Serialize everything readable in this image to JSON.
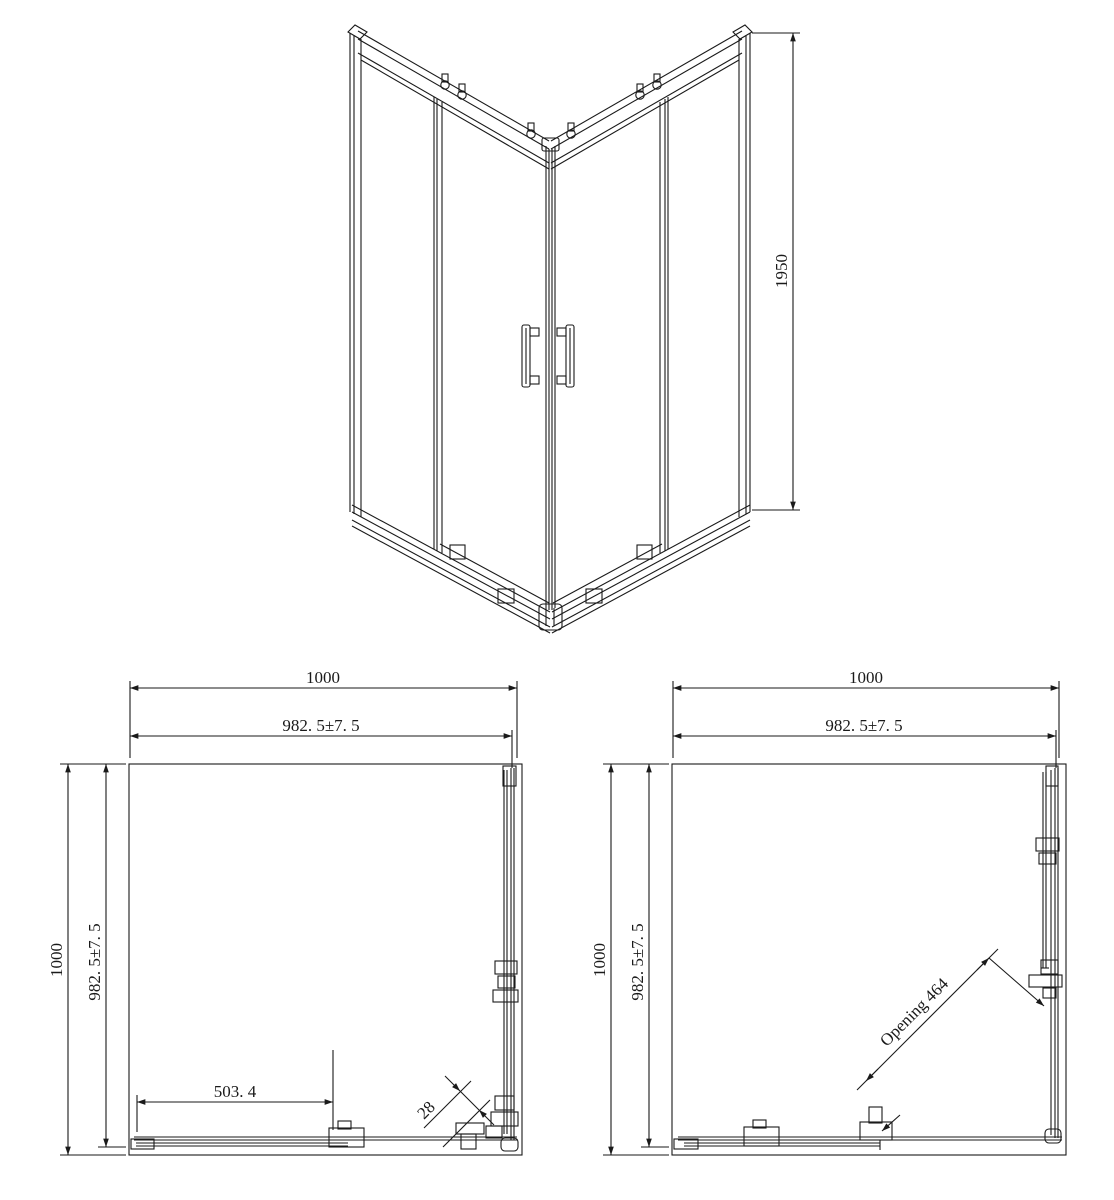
{
  "colors": {
    "background": "#ffffff",
    "ink": "#1a1a1a"
  },
  "perspective_view": {
    "height_label": "1950"
  },
  "plan_closed": {
    "overall_width_label": "1000",
    "glass_width_label": "982. 5±7. 5",
    "overall_depth_label": "1000",
    "glass_depth_label": "982. 5±7. 5",
    "panel_width_label": "503. 4",
    "profile_width_label": "28"
  },
  "plan_open": {
    "overall_width_label": "1000",
    "glass_width_label": "982. 5±7. 5",
    "overall_depth_label": "1000",
    "glass_depth_label": "982. 5±7. 5",
    "opening_label": "Opening 464"
  }
}
